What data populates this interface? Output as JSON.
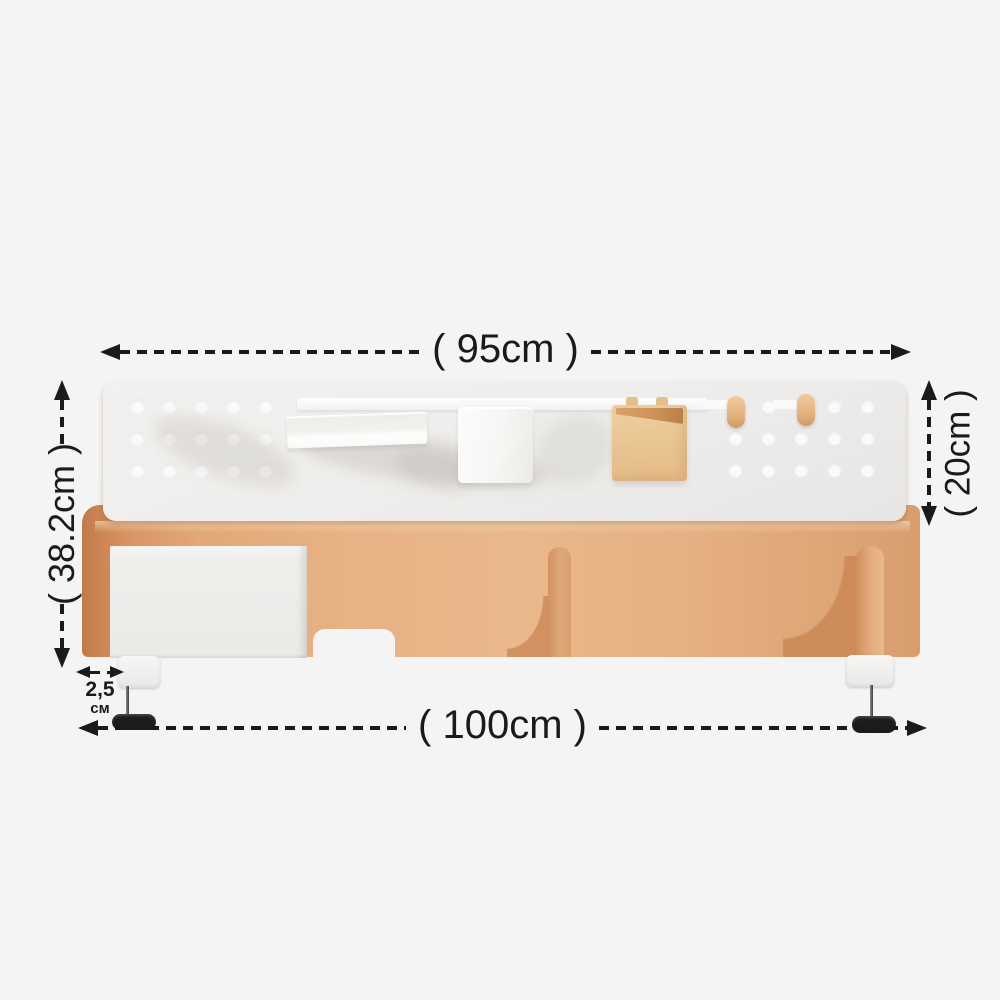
{
  "meta": {
    "description": "Dimension diagram of a clamp-on desk pegboard organizer shelf"
  },
  "colors": {
    "background": "#f4f4f4",
    "ink": "#1a1a1a",
    "wood": "#e7b285",
    "wood_dark": "#c07a49",
    "pegboard": "#efeeec",
    "white_accessory": "#f7f6f4",
    "tan_box": "#eac795",
    "knob": "#1c1c1c"
  },
  "dimensions": {
    "top_width": {
      "label": "( 95cm )"
    },
    "bottom_width": {
      "label": "( 100cm )"
    },
    "left_height": {
      "label": "( 38.2cm )"
    },
    "right_height": {
      "label": "( 20cm )"
    },
    "clamp_thickness": {
      "value": "2,5",
      "unit": "см"
    }
  },
  "product": {
    "pegboard_holes": {
      "rows": 3,
      "cols_left": 5,
      "cols_right": 5
    },
    "parts": [
      "pegboard",
      "wood-shelf",
      "drawer",
      "divider-post",
      "bookend-bracket",
      "desk-clamp-left",
      "desk-clamp-right"
    ],
    "accessories": [
      "shelf-rail",
      "tray",
      "pen-cup",
      "hanging-box",
      "wood-peg",
      "wood-peg"
    ]
  }
}
